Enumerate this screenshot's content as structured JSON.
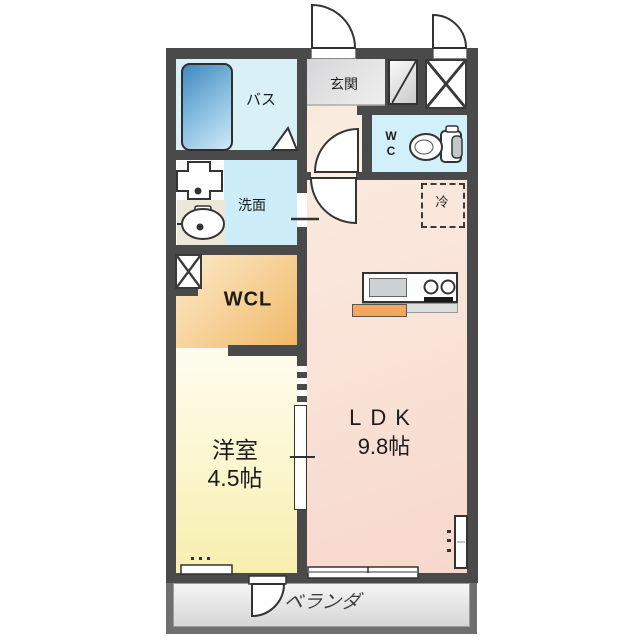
{
  "floorplan": {
    "type": "apartment-1LDK",
    "rooms": {
      "bath": {
        "label": "バス"
      },
      "washroom": {
        "label": "洗面"
      },
      "entrance": {
        "label": "玄関"
      },
      "toilet": {
        "letters": [
          "W",
          "C"
        ]
      },
      "refrigerator_space": {
        "label": "冷"
      },
      "walk_in_closet": {
        "label": "WCL"
      },
      "western_room": {
        "label": "洋室",
        "size": "4.5帖"
      },
      "ldk": {
        "label": "LDK",
        "size": "9.8帖"
      },
      "veranda": {
        "label": "ベランダ"
      }
    },
    "colors": {
      "wall": "#4a4a4a",
      "bath_floor": "#d9f0f7",
      "washroom_floor": "#cdeef8",
      "wc_floor": "#d2f0f9",
      "entrance_floor": "#e0e0e2",
      "hall_floor": "#f9ecdf",
      "ldk_floor": "#f8ddd2",
      "wcl_floor": "#f2bd72",
      "western_room_floor": "#f8f1b6",
      "veranda_floor": "#e3e3e3",
      "bathtub_blue": "#4288bd",
      "kitchen_counter_accent": "#f2a75f"
    }
  }
}
